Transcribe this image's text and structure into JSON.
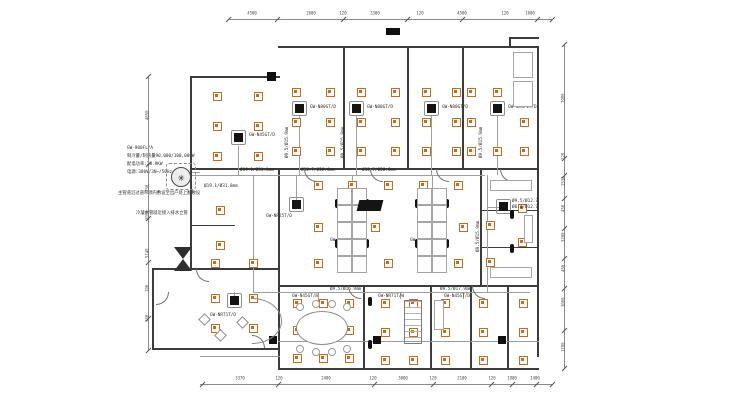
{
  "colors": {
    "diffuser_orange": "#c76b1d",
    "wall_dark": "#3c3c3c",
    "line_light": "#9a9a9a",
    "unit_black": "#141414",
    "background": "#ffffff"
  },
  "annotations": {
    "spec_lines": [
      "GW-900FL/A",
      "制冷量/制热量90,000/100,000W",
      "配电功率:28.9KW",
      "电源:380V/3N~/50Hz"
    ],
    "note1": "主管道沿过道吊顶内敷设至出户处上翻敷设",
    "note2": "冷凝水管就近接入排水立管"
  },
  "plan": {
    "walls": [
      [
        278,
        46,
        261,
        2
      ],
      [
        537,
        46,
        2,
        311
      ],
      [
        278,
        368,
        261,
        2
      ],
      [
        190,
        76,
        90,
        2
      ],
      [
        190,
        76,
        2,
        194
      ],
      [
        152,
        268,
        40,
        2
      ],
      [
        152,
        268,
        2,
        82
      ],
      [
        152,
        348,
        128,
        2
      ],
      [
        278,
        168,
        2,
        202
      ],
      [
        190,
        168,
        349,
        1.5
      ],
      [
        278,
        285,
        261,
        1.5
      ],
      [
        343,
        47,
        1.5,
        121
      ],
      [
        407,
        47,
        1.5,
        121
      ],
      [
        462,
        47,
        1.5,
        121
      ],
      [
        480,
        168,
        1.5,
        117
      ],
      [
        480,
        210,
        57,
        1.2
      ],
      [
        480,
        247,
        57,
        1.2
      ],
      [
        363,
        285,
        1.5,
        83
      ],
      [
        430,
        285,
        1.5,
        83
      ],
      [
        470,
        285,
        1.5,
        83
      ],
      [
        507,
        285,
        1.5,
        83
      ],
      [
        190,
        268,
        90,
        1.5
      ],
      [
        190,
        225,
        45,
        1.2
      ],
      [
        509,
        37,
        30,
        1.5
      ],
      [
        509,
        37,
        1.5,
        10
      ]
    ],
    "light_walls": [
      [
        278,
        341,
        261,
        1
      ],
      [
        200,
        356,
        80,
        1
      ]
    ],
    "columns": [
      [
        267,
        72,
        9,
        9
      ],
      [
        269,
        336,
        8,
        8
      ],
      [
        373,
        336,
        8,
        8
      ],
      [
        498,
        336,
        8,
        8
      ],
      [
        386,
        28,
        14,
        7
      ]
    ],
    "diffusers": [
      [
        217,
        96
      ],
      [
        258,
        96
      ],
      [
        217,
        126
      ],
      [
        258,
        126
      ],
      [
        217,
        156
      ],
      [
        258,
        156
      ],
      [
        296,
        92
      ],
      [
        330,
        92
      ],
      [
        296,
        122
      ],
      [
        330,
        122
      ],
      [
        296,
        151
      ],
      [
        330,
        151
      ],
      [
        361,
        92
      ],
      [
        395,
        92
      ],
      [
        361,
        122
      ],
      [
        395,
        122
      ],
      [
        361,
        151
      ],
      [
        395,
        151
      ],
      [
        426,
        92
      ],
      [
        456,
        92
      ],
      [
        426,
        122
      ],
      [
        456,
        122
      ],
      [
        426,
        151
      ],
      [
        456,
        151
      ],
      [
        471,
        92
      ],
      [
        497,
        92
      ],
      [
        524,
        92
      ],
      [
        471,
        122
      ],
      [
        524,
        122
      ],
      [
        471,
        151
      ],
      [
        497,
        151
      ],
      [
        524,
        151
      ],
      [
        220,
        210
      ],
      [
        220,
        245
      ],
      [
        215,
        263
      ],
      [
        253,
        263
      ],
      [
        318,
        185
      ],
      [
        352,
        185
      ],
      [
        388,
        185
      ],
      [
        423,
        185
      ],
      [
        458,
        185
      ],
      [
        318,
        227
      ],
      [
        375,
        227
      ],
      [
        463,
        227
      ],
      [
        318,
        263
      ],
      [
        352,
        263
      ],
      [
        388,
        263
      ],
      [
        423,
        263
      ],
      [
        458,
        263
      ],
      [
        522,
        208
      ],
      [
        490,
        225
      ],
      [
        522,
        242
      ],
      [
        490,
        262
      ],
      [
        215,
        298
      ],
      [
        253,
        298
      ],
      [
        215,
        328
      ],
      [
        253,
        328
      ],
      [
        297,
        303
      ],
      [
        323,
        303
      ],
      [
        349,
        303
      ],
      [
        297,
        330
      ],
      [
        323,
        330
      ],
      [
        349,
        330
      ],
      [
        297,
        358
      ],
      [
        323,
        358
      ],
      [
        349,
        358
      ],
      [
        385,
        303
      ],
      [
        413,
        303
      ],
      [
        385,
        332
      ],
      [
        413,
        332
      ],
      [
        385,
        360
      ],
      [
        413,
        360
      ],
      [
        445,
        303
      ],
      [
        445,
        332
      ],
      [
        445,
        360
      ],
      [
        483,
        303
      ],
      [
        483,
        332
      ],
      [
        483,
        360
      ],
      [
        523,
        303
      ],
      [
        523,
        332
      ],
      [
        523,
        360
      ]
    ],
    "units": [
      {
        "x": 238,
        "y": 137,
        "label": "GW-N45GT/D",
        "lx": 249,
        "ly": 133
      },
      {
        "x": 299,
        "y": 108,
        "label": "GW-N80GT/D",
        "lx": 310,
        "ly": 105
      },
      {
        "x": 356,
        "y": 108,
        "label": "GW-N80GT/D",
        "lx": 367,
        "ly": 105
      },
      {
        "x": 431,
        "y": 108,
        "label": "GW-N80GT/D",
        "lx": 442,
        "ly": 105
      },
      {
        "x": 497,
        "y": 108,
        "label": "GW-N5G71T/D",
        "lx": 508,
        "ly": 105
      },
      {
        "x": 296,
        "y": 204,
        "label": "GW-NR25T/D",
        "lx": 266,
        "ly": 214
      },
      {
        "x": 352,
        "y": 228,
        "label": "GW-NR140T/D",
        "lx": 330,
        "ly": 238
      },
      {
        "x": 432,
        "y": 228,
        "label": "GW-NR140T/D",
        "lx": 410,
        "ly": 238
      },
      {
        "x": 503,
        "y": 206,
        "label": "",
        "lx": 0,
        "ly": 0
      },
      {
        "x": 234,
        "y": 300,
        "label": "GW-NR71T/D",
        "lx": 210,
        "ly": 313
      }
    ],
    "unit_text_labels": [
      {
        "t": "GW-N45GT/B",
        "x": 292,
        "y": 294
      },
      {
        "t": "GW-NR71T/W",
        "x": 378,
        "y": 294
      },
      {
        "t": "GW-N45GT/D",
        "x": 444,
        "y": 294
      }
    ],
    "pipes": [
      [
        200,
        175,
        285,
        1
      ],
      [
        253,
        175,
        1,
        118
      ],
      [
        253,
        292,
        277,
        1
      ],
      [
        487,
        175,
        1,
        117
      ],
      [
        299,
        115,
        1,
        60
      ],
      [
        356,
        115,
        1,
        60
      ],
      [
        431,
        115,
        1,
        60
      ],
      [
        497,
        115,
        1,
        60
      ],
      [
        238,
        146,
        1,
        29
      ],
      [
        296,
        175,
        1,
        29
      ],
      [
        352,
        175,
        1,
        53
      ],
      [
        432,
        175,
        1,
        53
      ],
      [
        318,
        292,
        1,
        10
      ],
      [
        400,
        292,
        1,
        7
      ],
      [
        463,
        292,
        1,
        7
      ],
      [
        234,
        292,
        1,
        8
      ],
      [
        487,
        207,
        16,
        1
      ],
      [
        192,
        172,
        8,
        1
      ],
      [
        192,
        175,
        8,
        1
      ]
    ],
    "pipe_labels": [
      {
        "t": "Ø19.1/Ø31.8mm",
        "x": 204,
        "y": 184,
        "rot": 0
      },
      {
        "t": "Ø19.1/Ø31.8mm",
        "x": 240,
        "y": 168,
        "rot": 0
      },
      {
        "t": "Ø12.7/Ø28.6mm",
        "x": 301,
        "y": 168,
        "rot": 0
      },
      {
        "t": "Ø12.7/Ø28.6mm",
        "x": 362,
        "y": 168,
        "rot": 0
      },
      {
        "t": "Ø9.5/Ø15.9mm",
        "x": 285,
        "y": 158,
        "rot": 1
      },
      {
        "t": "Ø9.5/Ø15.9mm",
        "x": 341,
        "y": 158,
        "rot": 1
      },
      {
        "t": "Ø9.5/Ø15.9mm",
        "x": 479,
        "y": 158,
        "rot": 1
      },
      {
        "t": "Ø9.5/Ø15.9mm",
        "x": 476,
        "y": 252,
        "rot": 1
      },
      {
        "t": "Ø9.5/Ø15.9mm",
        "x": 330,
        "y": 287,
        "rot": 0
      },
      {
        "t": "Ø9.5/Ø17.9mm",
        "x": 440,
        "y": 287,
        "rot": 0
      },
      {
        "t": "Ø9.5/Ø12.7",
        "x": 512,
        "y": 199,
        "rot": 0
      },
      {
        "t": "Ø6.4/Ø12.7",
        "x": 512,
        "y": 205,
        "rot": 0
      }
    ],
    "chairs": [
      [
        337,
        203
      ],
      [
        367,
        203
      ],
      [
        337,
        243
      ],
      [
        367,
        243
      ],
      [
        417,
        203
      ],
      [
        447,
        203
      ],
      [
        417,
        243
      ],
      [
        447,
        243
      ],
      [
        370,
        301
      ],
      [
        370,
        344
      ],
      [
        512,
        214
      ],
      [
        512,
        248
      ]
    ],
    "doors": [
      {
        "x": 304,
        "y": 169,
        "r": 0
      },
      {
        "x": 370,
        "y": 169,
        "r": 0
      },
      {
        "x": 436,
        "y": 169,
        "r": 0
      },
      {
        "x": 500,
        "y": 169,
        "r": 0
      },
      {
        "x": 348,
        "y": 286,
        "r": 0
      },
      {
        "x": 472,
        "y": 286,
        "r": 0
      },
      {
        "x": 196,
        "y": 269,
        "r": 0
      },
      {
        "x": 156,
        "y": 292,
        "r": 270
      },
      {
        "x": 252,
        "y": 335,
        "r": 180
      }
    ],
    "furniture": [
      {
        "type": "deskgrid",
        "x": 337,
        "y": 188,
        "cols": 2,
        "rows": 5,
        "cw": 15,
        "ch": 17,
        "name": "workstation-cluster"
      },
      {
        "type": "deskgrid",
        "x": 417,
        "y": 188,
        "cols": 2,
        "rows": 5,
        "cw": 15,
        "ch": 17,
        "name": "workstation-cluster"
      },
      {
        "type": "ellipse",
        "x": 296,
        "y": 311,
        "w": 52,
        "h": 34,
        "name": "conference-table"
      },
      {
        "type": "circle",
        "x": 300,
        "y": 307,
        "r": 4,
        "name": "chair"
      },
      {
        "type": "circle",
        "x": 316,
        "y": 304,
        "r": 4,
        "name": "chair"
      },
      {
        "type": "circle",
        "x": 332,
        "y": 304,
        "r": 4,
        "name": "chair"
      },
      {
        "type": "circle",
        "x": 347,
        "y": 307,
        "r": 4,
        "name": "chair"
      },
      {
        "type": "circle",
        "x": 300,
        "y": 349,
        "r": 4,
        "name": "chair"
      },
      {
        "type": "circle",
        "x": 316,
        "y": 352,
        "r": 4,
        "name": "chair"
      },
      {
        "type": "circle",
        "x": 332,
        "y": 352,
        "r": 4,
        "name": "chair"
      },
      {
        "type": "circle",
        "x": 347,
        "y": 349,
        "r": 4,
        "name": "chair"
      },
      {
        "type": "arcdesk",
        "x": 252,
        "y": 298,
        "w": 30,
        "h": 46,
        "name": "reception-desk"
      },
      {
        "type": "diamond",
        "x": 200,
        "y": 315,
        "s": 9,
        "name": "plant"
      },
      {
        "type": "diamond",
        "x": 216,
        "y": 331,
        "s": 9,
        "name": "plant"
      },
      {
        "type": "diamond",
        "x": 238,
        "y": 318,
        "s": 9,
        "name": "plant"
      },
      {
        "type": "ladder",
        "x": 404,
        "y": 300,
        "w": 18,
        "h": 44,
        "name": "shelf"
      },
      {
        "type": "rect",
        "x": 513,
        "y": 52,
        "w": 20,
        "h": 26,
        "name": "elevator"
      },
      {
        "type": "rect",
        "x": 513,
        "y": 81,
        "w": 20,
        "h": 26,
        "name": "elevator"
      },
      {
        "type": "rect",
        "x": 490,
        "y": 180,
        "w": 42,
        "h": 11,
        "name": "desk"
      },
      {
        "type": "rect",
        "x": 490,
        "y": 267,
        "w": 42,
        "h": 11,
        "name": "desk"
      },
      {
        "type": "rect",
        "x": 524,
        "y": 215,
        "w": 9,
        "h": 28,
        "name": "desk"
      },
      {
        "type": "rect",
        "x": 434,
        "y": 300,
        "w": 10,
        "h": 30,
        "name": "desk"
      },
      {
        "type": "screen",
        "x": 358,
        "y": 200,
        "w": 24,
        "h": 11,
        "name": "projector-screen"
      },
      {
        "type": "odu",
        "x": 181,
        "y": 177,
        "name": "outdoor-unit"
      },
      {
        "type": "odubox",
        "x": 166,
        "y": 163,
        "w": 30,
        "h": 27,
        "name": "outdoor-unit-pad"
      },
      {
        "type": "bowtie",
        "x": 174,
        "y": 247,
        "name": "stair-symbol"
      }
    ],
    "dims": [
      {
        "orient": "h",
        "pos": 19,
        "from": 228,
        "to": 552,
        "ticks": [
          228,
          277,
          343,
          407,
          462,
          537,
          552
        ],
        "labels": [
          {
            "t": "4500",
            "at": 252
          },
          {
            "t": "2600",
            "at": 311
          },
          {
            "t": "120",
            "at": 343
          },
          {
            "t": "3300",
            "at": 375
          },
          {
            "t": "120",
            "at": 420
          },
          {
            "t": "4500",
            "at": 462
          },
          {
            "t": "120",
            "at": 505
          },
          {
            "t": "1600",
            "at": 530
          }
        ]
      },
      {
        "orient": "h",
        "pos": 384,
        "from": 200,
        "to": 552,
        "ticks": [
          202,
          278,
          374,
          433,
          491,
          512,
          536,
          552
        ],
        "labels": [
          {
            "t": "3370",
            "at": 240
          },
          {
            "t": "120",
            "at": 279
          },
          {
            "t": "2400",
            "at": 326
          },
          {
            "t": "120",
            "at": 373
          },
          {
            "t": "3000",
            "at": 403
          },
          {
            "t": "120",
            "at": 433
          },
          {
            "t": "2100",
            "at": 462
          },
          {
            "t": "120",
            "at": 492
          },
          {
            "t": "1900",
            "at": 512
          },
          {
            "t": "1400",
            "at": 535
          }
        ]
      },
      {
        "orient": "v",
        "pos": 148,
        "from": 76,
        "to": 350,
        "ticks": [
          76,
          164,
          218,
          262,
          318,
          350
        ],
        "labels": [
          {
            "t": "4650",
            "at": 120
          },
          {
            "t": "750",
            "at": 192
          },
          {
            "t": "2016",
            "at": 220
          },
          {
            "t": "5140",
            "at": 258
          },
          {
            "t": "190",
            "at": 292
          },
          {
            "t": "530",
            "at": 322
          }
        ]
      },
      {
        "orient": "v",
        "pos": 564,
        "from": 44,
        "to": 368,
        "ticks": [
          44,
          158,
          175,
          198,
          228,
          258,
          288,
          330,
          368
        ],
        "labels": [
          {
            "t": "7900",
            "at": 103
          },
          {
            "t": "120",
            "at": 160
          },
          {
            "t": "1530",
            "at": 186
          },
          {
            "t": "450",
            "at": 212
          },
          {
            "t": "3200",
            "at": 242
          },
          {
            "t": "450",
            "at": 272
          },
          {
            "t": "3000",
            "at": 307
          },
          {
            "t": "1700",
            "at": 352
          }
        ]
      }
    ]
  }
}
